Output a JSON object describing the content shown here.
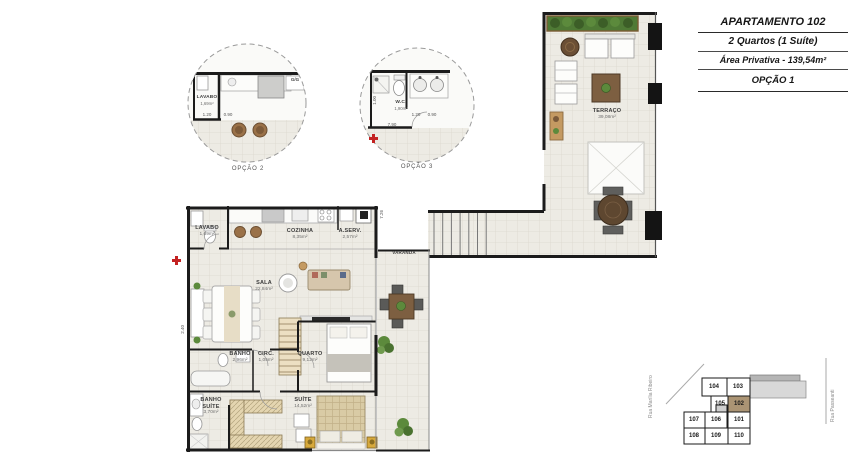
{
  "title_block": {
    "apartment": "APARTAMENTO 102",
    "type": "2 Quartos (1 Suíte)",
    "private_area": "Área Privativa - 139,54m²",
    "option": "OPÇÃO 1"
  },
  "details": {
    "circle1": {
      "caption": "OPÇÃO 2",
      "room": "LAVABO",
      "area": "1,69m²",
      "tag": "G/G",
      "dim1": "1.20",
      "dim2": "0.90"
    },
    "circle2": {
      "caption": "OPÇÃO 3",
      "room": "W.C.",
      "area": "1,90m²",
      "dim1": "1.00",
      "dim2": "1.20",
      "dim3": "0.90",
      "dim4": "7.90"
    }
  },
  "plan": {
    "rooms": {
      "terraco": {
        "name": "TERRAÇO",
        "area": "39,08m²"
      },
      "lavabo": {
        "name": "LAVABO",
        "area": "1,69m²"
      },
      "cozinha": {
        "name": "COZINHA",
        "area": "8,35m²"
      },
      "aserv": {
        "name": "A.SERV.",
        "area": "2,57m²"
      },
      "varanda": {
        "name": "VARANDA"
      },
      "sala": {
        "name": "SALA",
        "area": "22,84m²"
      },
      "banho": {
        "name": "BANHO",
        "area": "2,96m²"
      },
      "circ": {
        "name": "CIRC.",
        "area": "1,05m²"
      },
      "quarto": {
        "name": "QUARTO",
        "area": "9,12m²"
      },
      "banho_suite": {
        "name": "BANHO SUÍTE",
        "area": "3,70m²"
      },
      "suite": {
        "name": "SUÍTE",
        "area": "14,52m²"
      }
    },
    "dims": {
      "d_right": "7.26",
      "d_left": "2.40"
    }
  },
  "keyplan": {
    "street_left": "Rua Marília Ribeiro",
    "street_right": "Rua Passeanti",
    "units": [
      "104",
      "103",
      "105",
      "102",
      "107",
      "106",
      "101",
      "108",
      "109",
      "110"
    ],
    "highlighted_unit": "102"
  }
}
